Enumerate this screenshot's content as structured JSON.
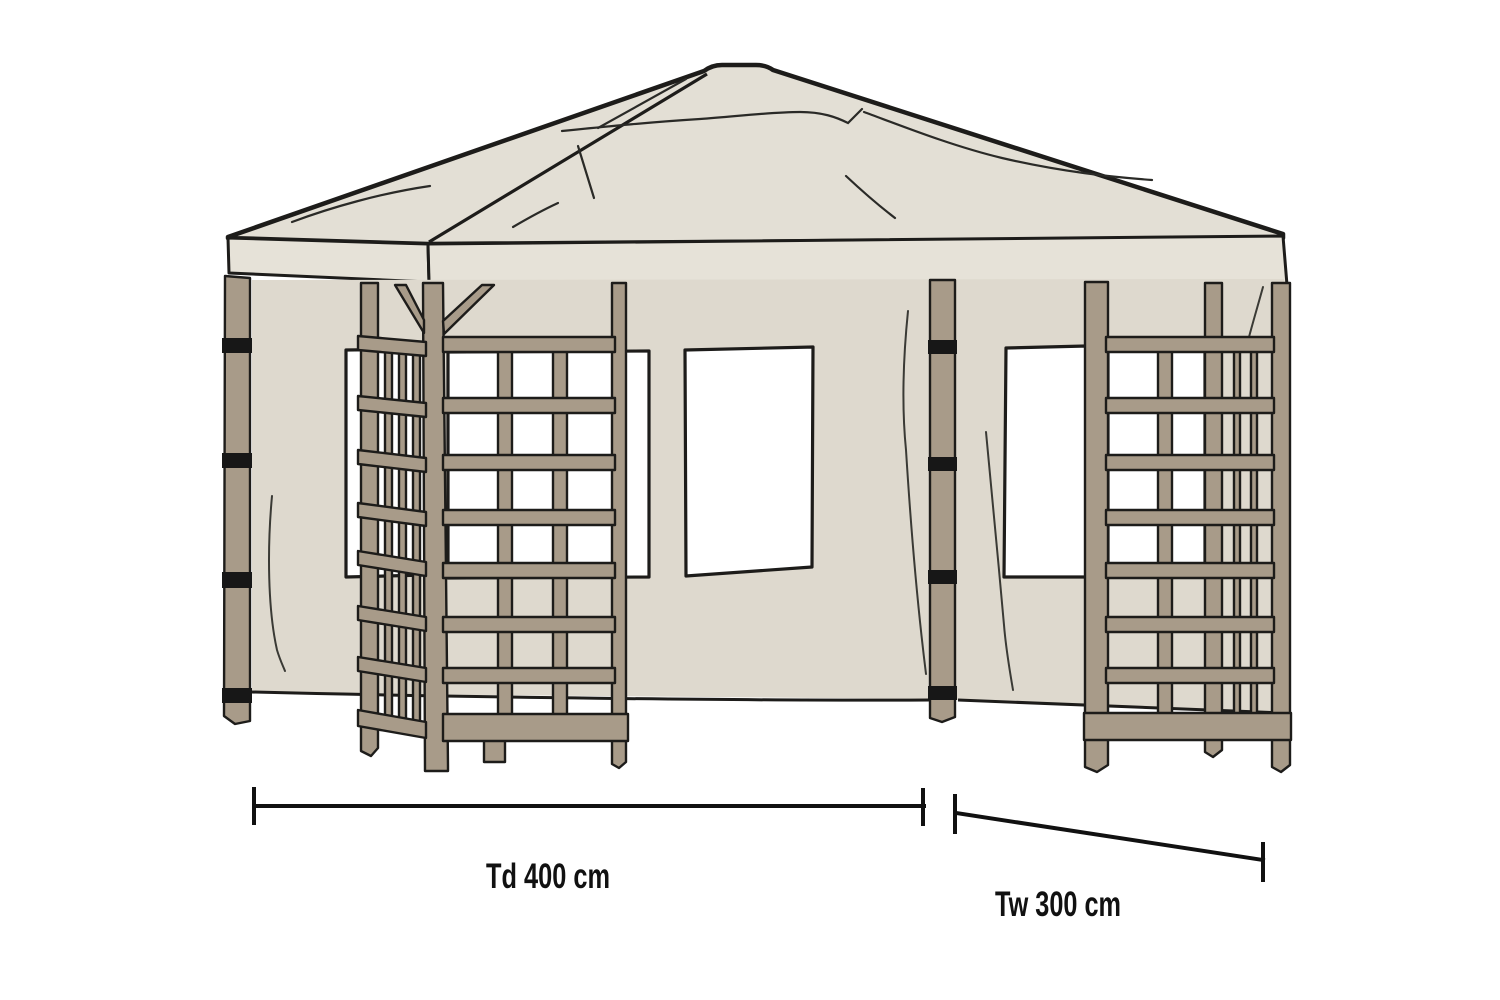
{
  "labels": {
    "depth": "Td 400 cm",
    "width": "Tw 300 cm"
  },
  "colors": {
    "background": "#ffffff",
    "canopy": "#e3dfd5",
    "fascia": "#e6e2d8",
    "wall": "#ded9ce",
    "window": "#ffffff",
    "wood": "#a89b89",
    "strap": "#171717",
    "outline": "#1d1c1a",
    "fold": "#3a3a35",
    "dimension": "#111111"
  }
}
